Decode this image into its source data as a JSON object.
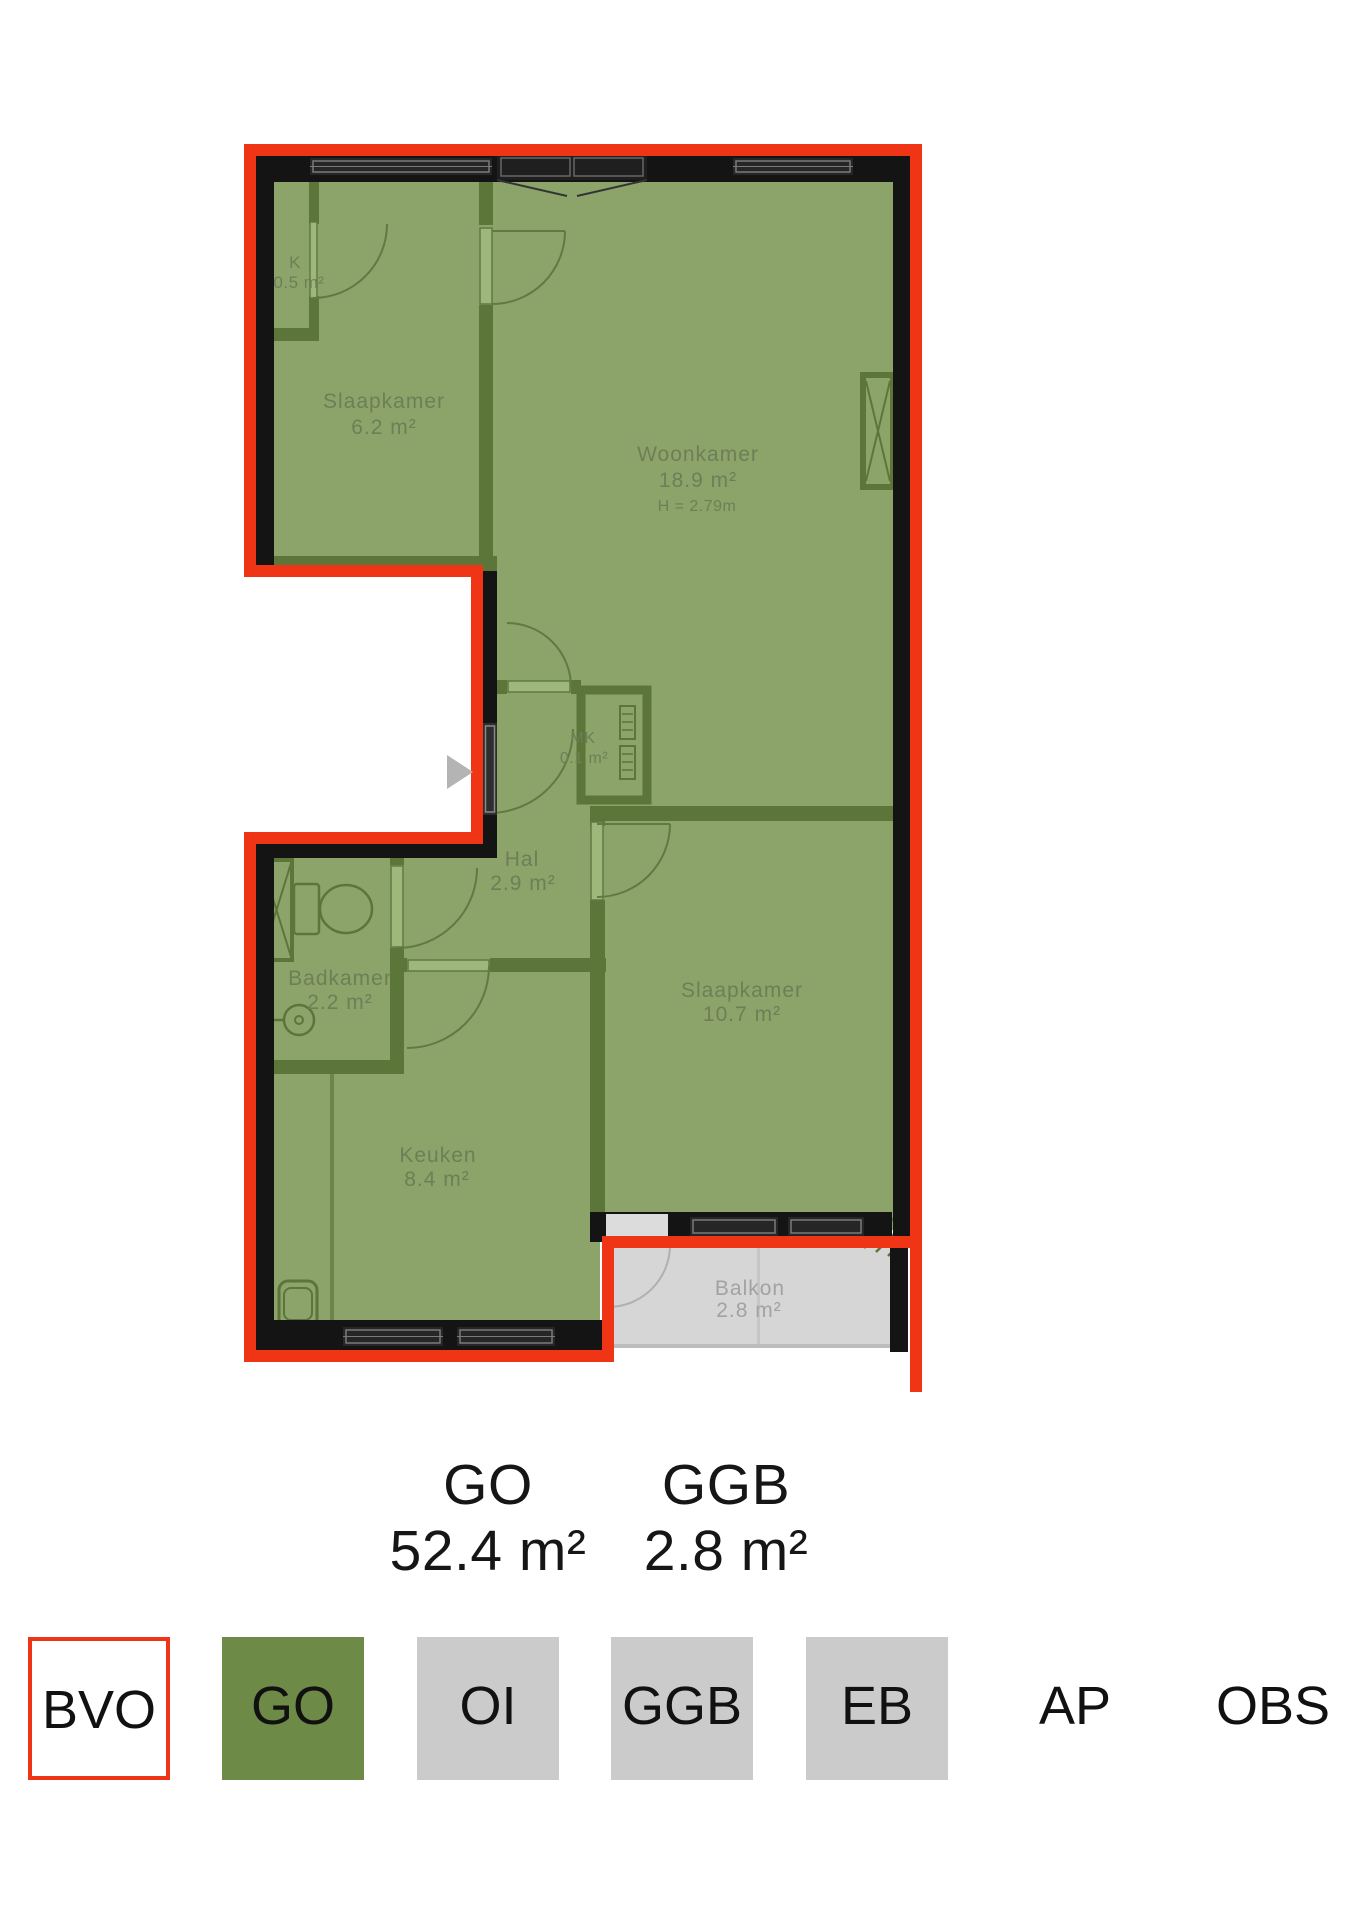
{
  "plan": {
    "rooms": [
      {
        "name": "K",
        "area": "0.5 m²"
      },
      {
        "name": "Slaapkamer",
        "area": "6.2 m²"
      },
      {
        "name": "Woonkamer",
        "area": "18.9 m²",
        "height": "H = 2.79m"
      },
      {
        "name": "MK",
        "area": "0.1 m²"
      },
      {
        "name": "Hal",
        "area": "2.9 m²"
      },
      {
        "name": "Badkamer",
        "area": "2.2 m²"
      },
      {
        "name": "Slaapkamer",
        "area": "10.7 m²"
      },
      {
        "name": "Keuken",
        "area": "8.4 m²"
      },
      {
        "name": "Balkon",
        "area": "2.8 m²"
      }
    ],
    "colors": {
      "bvo_outline_red": "#f03517",
      "go_room_fill": "#8ca46a",
      "interior_wall_green": "#5c7539",
      "exterior_wall_black": "#141414",
      "balkon_fill": "#d6d6d6",
      "room_label": "#6e7e57",
      "balkon_label": "#a2a2a2"
    }
  },
  "summary": {
    "items": [
      {
        "label": "GO",
        "value": "52.4 m²"
      },
      {
        "label": "GGB",
        "value": "2.8 m²"
      }
    ]
  },
  "legend": {
    "items": [
      {
        "label": "BVO",
        "style": "outline"
      },
      {
        "label": "GO",
        "style": "green"
      },
      {
        "label": "OI",
        "style": "gray"
      },
      {
        "label": "GGB",
        "style": "gray"
      },
      {
        "label": "EB",
        "style": "gray"
      },
      {
        "label": "AP",
        "style": "none"
      },
      {
        "label": "OBS",
        "style": "none"
      }
    ]
  }
}
